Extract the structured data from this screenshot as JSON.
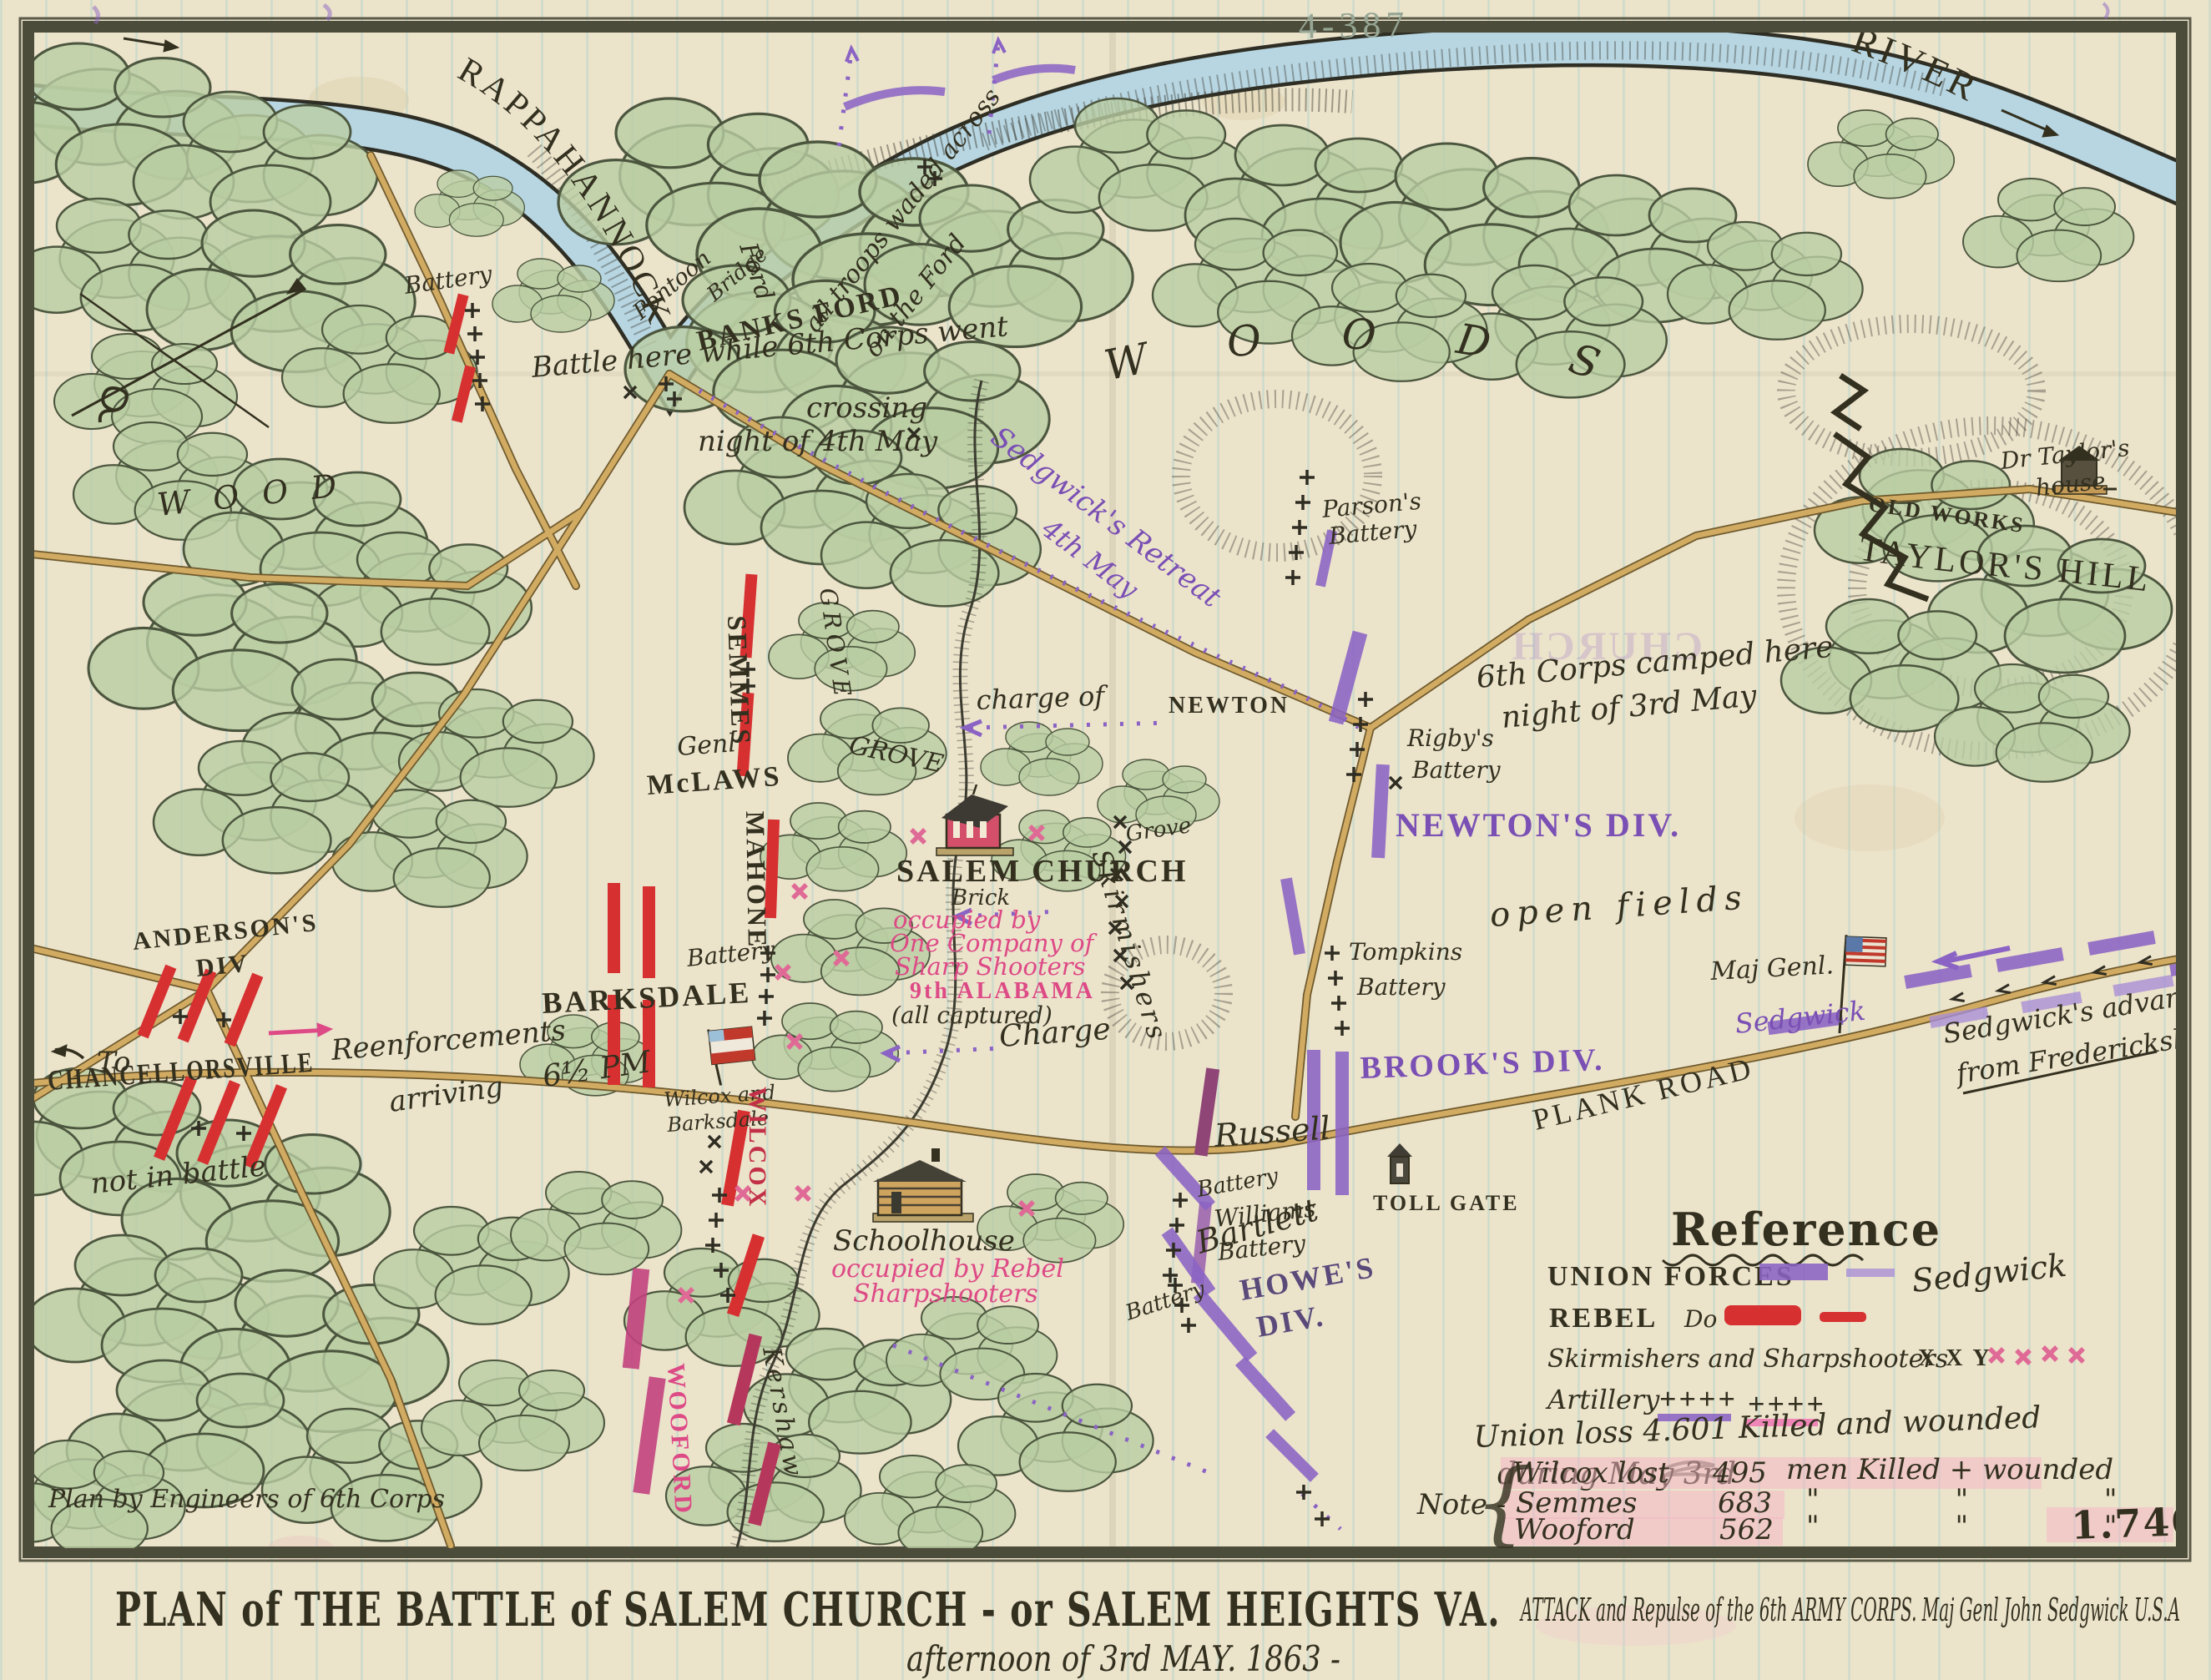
{
  "page": {
    "archival_number": "4-387"
  },
  "colors": {
    "union_purple": "#8a63c4",
    "rebel_red": "#d63031",
    "magenta": "#dd4a86",
    "ink": "#33301f",
    "paper": "#ece3cb",
    "river_blue": "#b7d6e2",
    "road_tan": "#d2ab62",
    "woods_green": "#b9cda2"
  },
  "river": {
    "name_upper": "RAPPAHANNOCK",
    "name_lower": "RIVER"
  },
  "labels": {
    "ford": "Ford",
    "pontoon": "Pontoon",
    "bridge": "Bridge",
    "waded1": "all troops waded across",
    "waded2": "on the Ford",
    "banks_ford": "BANKS FORD",
    "battle1": "Battle here while 6th Corps went",
    "battle2": "crossing",
    "battle3": "night of 4th May",
    "retreat1": "Sedgwick's Retreat",
    "retreat2": "4th May",
    "woods": "WOODS",
    "taylors_hill": "TAYLOR'S HILL",
    "old_works": "OLD WORKS",
    "dr_taylor1": "Dr Taylor's",
    "dr_taylor2": "house",
    "church_bleed": "CHURCH",
    "parsons1": "Parson's",
    "battery": "Battery",
    "semmes": "SEMMES",
    "grove": "GROVE",
    "grove_s": "Grove",
    "mclaws1": "Genl",
    "mclaws2": "McLAWS",
    "mahone": "MAHONE",
    "barksdale": "BARKSDALE",
    "barksdale_s": "Barksdale",
    "wilcox_and": "Wilcox and",
    "wilcox": "WILCOX",
    "time": "6½ PM",
    "salem_church": "SALEM CHURCH",
    "brick": "Brick",
    "occ1": "occupied by",
    "occ2": "One Company of",
    "occ3": "Sharp Shooters",
    "occ4": "9th ALABAMA",
    "captured": "(all captured)",
    "skirmishers": "Skirmishers",
    "charge_of": "charge of",
    "newton": "NEWTON",
    "charge": "Charge",
    "camped1": "6th Corps camped here",
    "camped2": "night of 3rd May",
    "rigbys": "Rigby's",
    "newtons_div": "NEWTON'S DIV.",
    "open_fields": "open fields",
    "tompkins": "Tompkins",
    "russell": "Russell",
    "brooks_div": "BROOK'S DIV.",
    "plank_road": "PLANK ROAD",
    "toll_gate": "TOLL GATE",
    "williams": "Williams",
    "bartlett": "Bartlett",
    "howes1": "HOWE'S",
    "howes2": "DIV.",
    "school1": "Schoolhouse",
    "school2": "occupied by Rebel",
    "school3": "Sharpshooters",
    "kershaw": "Kershaw",
    "wooford": "WOOFORD",
    "andersons1": "ANDERSON'S",
    "andersons2": "DIV",
    "to": "To",
    "chancellorsville": "CHANCELLORSVILLE",
    "reenf1": "Reenforcements",
    "reenf2": "arriving",
    "not_in_battle": "not in battle",
    "maj_genl": "Maj Genl.",
    "sedgwick": "Sedgwick",
    "advance1": "Sedgwick's advance",
    "advance2": "from Fredericksburg",
    "plan_by": "Plan by Engineers of 6th Corps"
  },
  "legend": {
    "heading": "Reference",
    "union": "UNION FORCES",
    "union_name": "Sedgwick",
    "rebel": "REBEL",
    "ditto": "Do",
    "skirm": "Skirmishers and Sharpshooters",
    "skirm_marks": "X X Y",
    "artillery": "Artillery",
    "artillery_marks1": "++++",
    "artillery_marks2": "++++",
    "loss1": "Union loss 4.601 Killed and wounded",
    "loss2": "during May 3rd"
  },
  "note": {
    "label": "Note -",
    "brace": "{",
    "rows": [
      {
        "name": "Wilcox lost",
        "value": "495",
        "suffix": "men Killed + wounded"
      },
      {
        "name": "Semmes",
        "value": "683",
        "suffix": "\" \" \""
      },
      {
        "name": "Wooford",
        "value": "562",
        "suffix": "\" \" \""
      }
    ],
    "total": "1.740"
  },
  "title": {
    "line1": "PLAN of THE BATTLE of SALEM CHURCH - or SALEM HEIGHTS VA.",
    "line2": "ATTACK and Repulse of the 6th ARMY CORPS. Maj Genl John Sedgwick U.S.A",
    "line3": "afternoon of 3rd MAY. 1863 -"
  }
}
